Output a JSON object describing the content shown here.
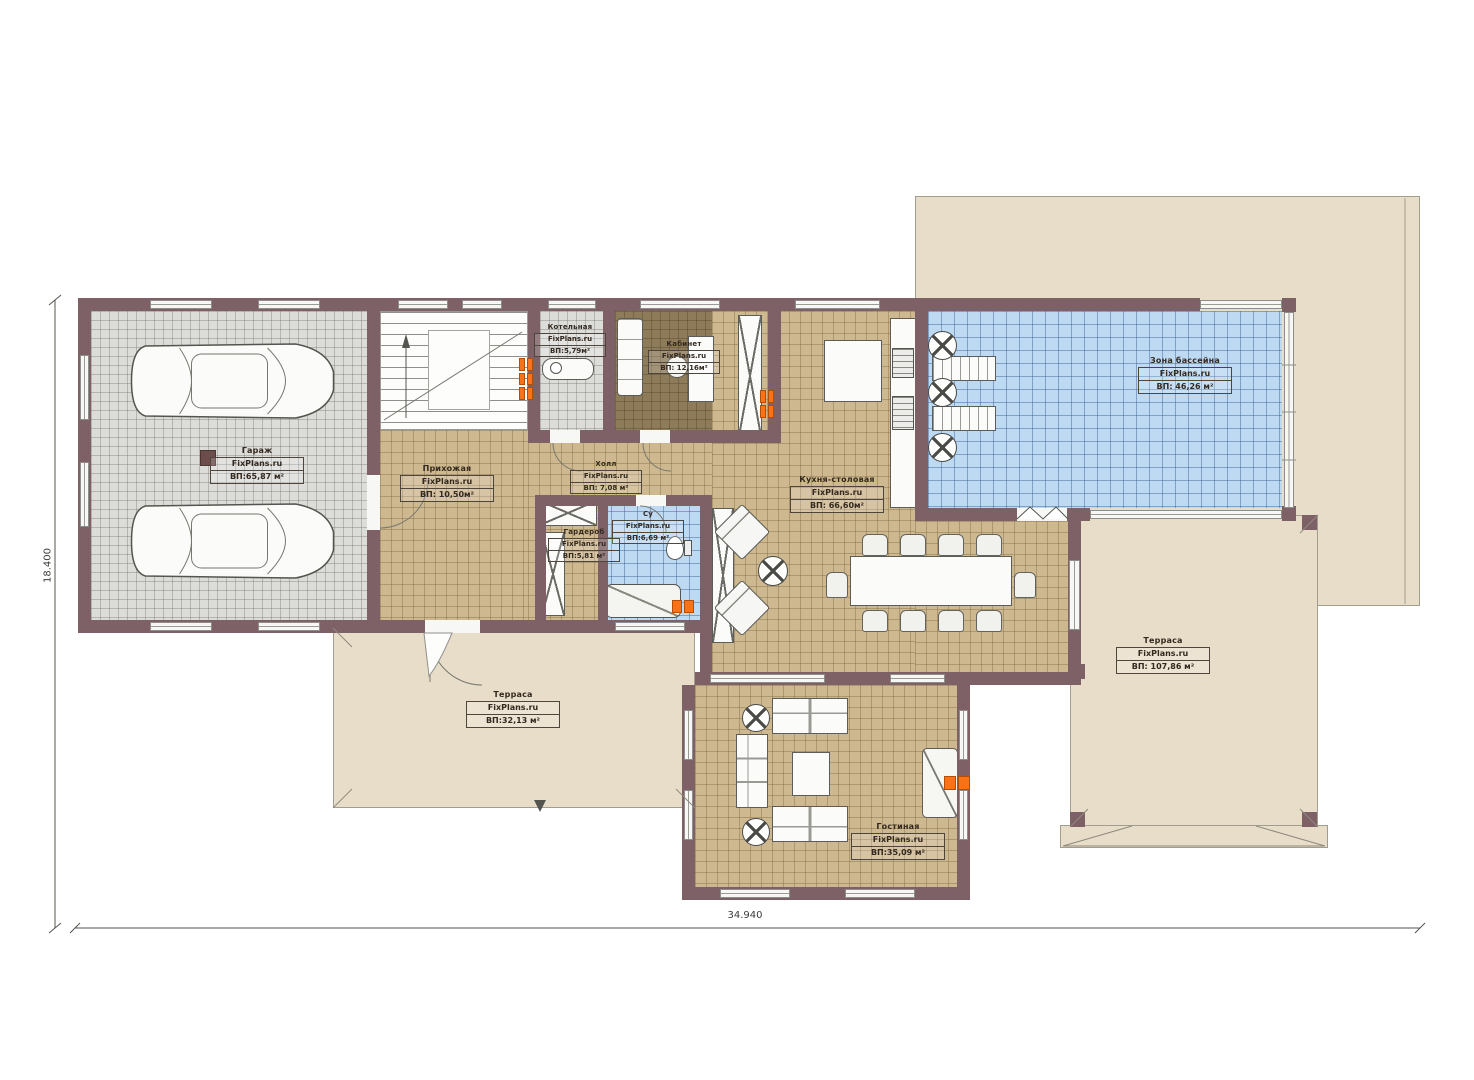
{
  "plan": {
    "watermark": "FixPlans.ru",
    "dimensions": {
      "width_label": "34.940",
      "height_label": "18.400"
    },
    "colors": {
      "wall": "#7d6166",
      "wood_floor": "#cdb890",
      "tile_gray": "#dcdcd9",
      "water_blue": "#bed9f2",
      "office_floor": "#8e7b59",
      "terrace_beige": "#e8ddc9",
      "radiator_orange": "#f97316"
    },
    "rooms": [
      {
        "id": "garage",
        "name": "Гараж",
        "watermark": "FixPlans.ru",
        "area": "ВП:65,87 м²"
      },
      {
        "id": "boiler",
        "name": "Котельная",
        "watermark": "FixPlans.ru",
        "area": "ВП:5,79м²"
      },
      {
        "id": "office",
        "name": "Кабинет",
        "watermark": "FixPlans.ru",
        "area": "ВП: 12,16м²"
      },
      {
        "id": "entry",
        "name": "Прихожая",
        "watermark": "FixPlans.ru",
        "area": "ВП: 10,50м²"
      },
      {
        "id": "hall",
        "name": "Холл",
        "watermark": "FixPlans.ru",
        "area": "ВП: 7,08 м²"
      },
      {
        "id": "wc",
        "name": "Су",
        "watermark": "FixPlans.ru",
        "area": "ВП:6,69 м²"
      },
      {
        "id": "wardrobe",
        "name": "Гардероб",
        "watermark": "FixPlans.ru",
        "area": "ВП:5,81 м²"
      },
      {
        "id": "kitchen",
        "name": "Кухня-столовая",
        "watermark": "FixPlans.ru",
        "area": "ВП: 66,60м²"
      },
      {
        "id": "pool",
        "name": "Зона бассейна",
        "watermark": "FixPlans.ru",
        "area": "ВП: 46,26 м²"
      },
      {
        "id": "terrace_left",
        "name": "Терраса",
        "watermark": "FixPlans.ru",
        "area": "ВП:32,13 м²"
      },
      {
        "id": "terrace_right",
        "name": "Терраса",
        "watermark": "FixPlans.ru",
        "area": "ВП: 107,86 м²"
      },
      {
        "id": "living",
        "name": "Гостиная",
        "watermark": "FixPlans.ru",
        "area": "ВП:35,09 м²"
      }
    ]
  }
}
